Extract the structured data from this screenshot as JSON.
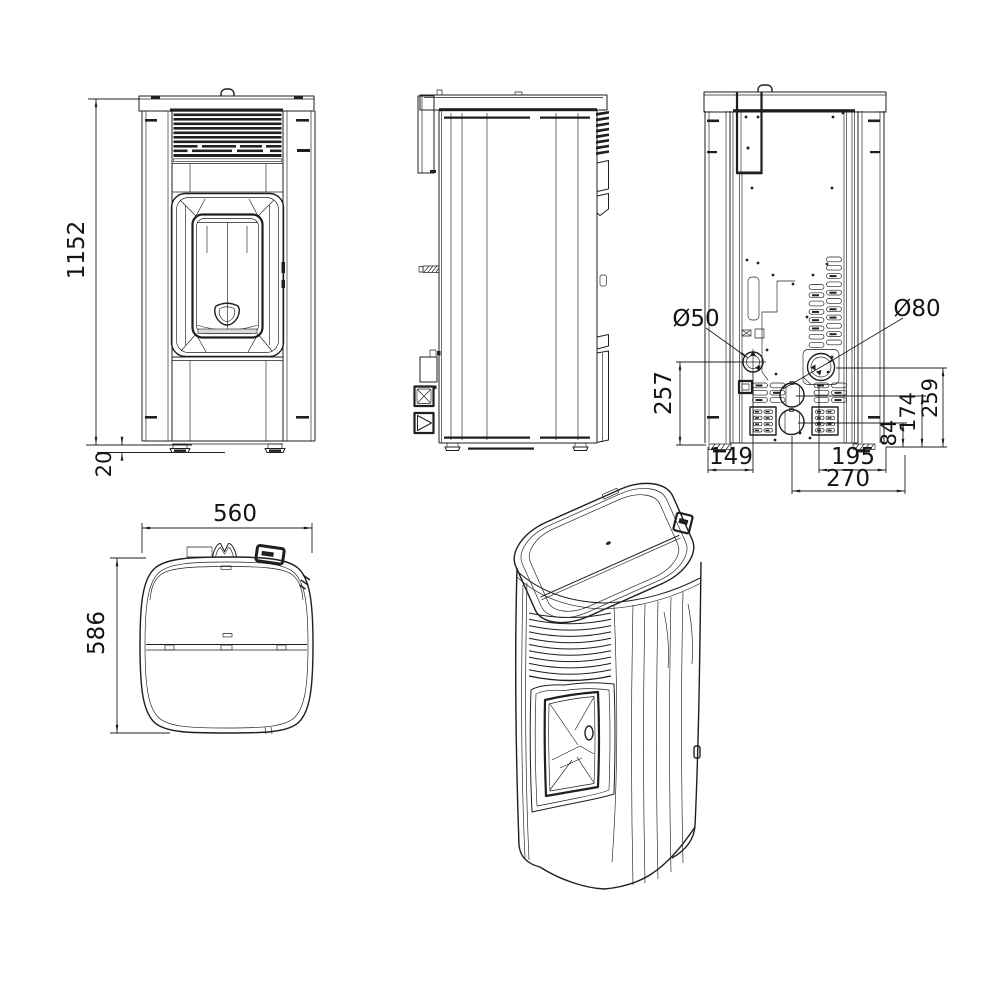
{
  "drawing": {
    "subject": "pellet-stove-technical-drawing",
    "background": "#ffffff",
    "line_color": "#1f1f1f",
    "views": {
      "front": "front-view",
      "side": "side-view",
      "back": "back-view",
      "top": "top-view",
      "iso": "isometric-view"
    }
  },
  "dimensions": {
    "front": {
      "overall_height": "1152",
      "foot_height": "20"
    },
    "back": {
      "air_intake_diameter": "Ø50",
      "flue_diameter": "Ø80",
      "intake_center_height": "257",
      "flue_center_height": "259",
      "mid_port_center_height": "174",
      "low_port_center_height": "84",
      "intake_offset_from_left": "149",
      "flue_offset_from_right": "195",
      "port_offset_from_right": "270"
    },
    "top": {
      "overall_width": "560",
      "overall_depth": "586"
    }
  }
}
